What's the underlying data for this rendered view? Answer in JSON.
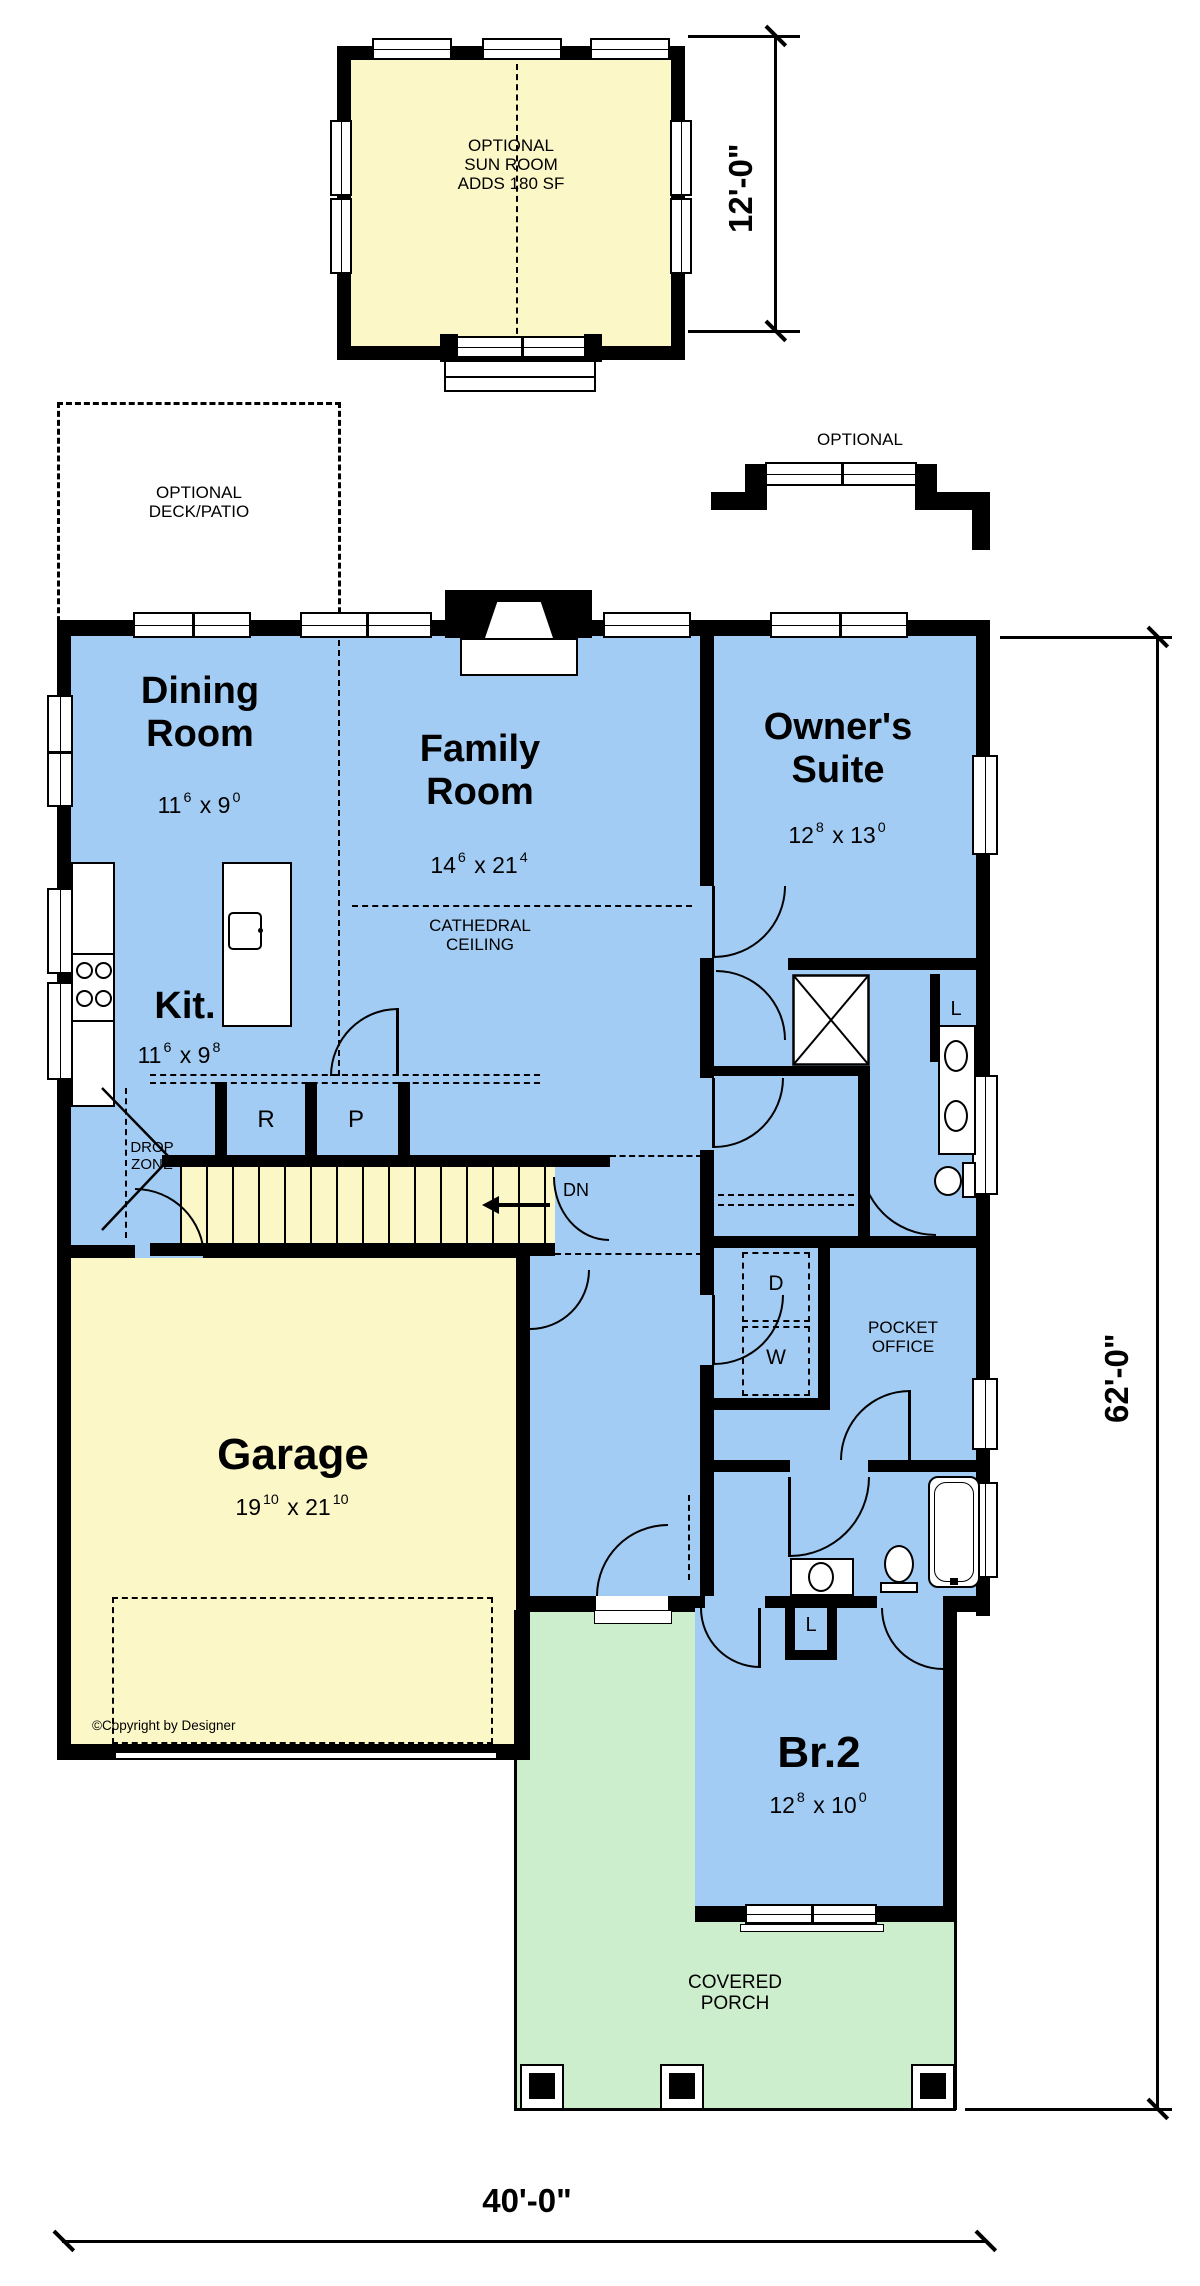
{
  "palette": {
    "wall": "#000000",
    "room": "#A2CCF3",
    "garage": "#FBF7C7",
    "porch": "#CCEECC",
    "paper": "#FFFFFF"
  },
  "annotations": {
    "sun_room": "OPTIONAL\nSUN ROOM\nADDS 180 SF",
    "deck": "OPTIONAL\nDECK/PATIO",
    "bay": "OPTIONAL",
    "cathedral": "CATHEDRAL\nCEILING",
    "copyright": "©Copyright by Designer"
  },
  "dimensions": {
    "sun_room_depth": "12'-0\"",
    "house_depth": "62'-0\"",
    "house_width": "40'-0\""
  },
  "rooms": {
    "dining": {
      "name": "Dining\nRoom",
      "size_a": "11",
      "size_a_sup": "6",
      "size_b": "x 9",
      "size_b_sup": "0"
    },
    "family": {
      "name": "Family\nRoom",
      "size_a": "14",
      "size_a_sup": "6",
      "size_b": "x 21",
      "size_b_sup": "4"
    },
    "owners": {
      "name": "Owner's\nSuite",
      "size_a": "12",
      "size_a_sup": "8",
      "size_b": "x 13",
      "size_b_sup": "0"
    },
    "kitchen": {
      "name": "Kit.",
      "size_a": "11",
      "size_a_sup": "6",
      "size_b": "x 9",
      "size_b_sup": "8"
    },
    "garage": {
      "name": "Garage",
      "size_a": "19",
      "size_a_sup": "10",
      "size_b": "x 21",
      "size_b_sup": "10"
    },
    "br2": {
      "name": "Br.2",
      "size_a": "12",
      "size_a_sup": "8",
      "size_b": "x 10",
      "size_b_sup": "0"
    },
    "pocket_office": "POCKET\nOFFICE",
    "drop_zone": "DROP\nZONE",
    "covered_porch": "COVERED\nPORCH"
  },
  "markers": {
    "down": "DN",
    "refrigerator": "R",
    "pantry": "P",
    "dryer": "D",
    "washer": "W",
    "linen_owner": "L",
    "linen_hall": "L"
  }
}
